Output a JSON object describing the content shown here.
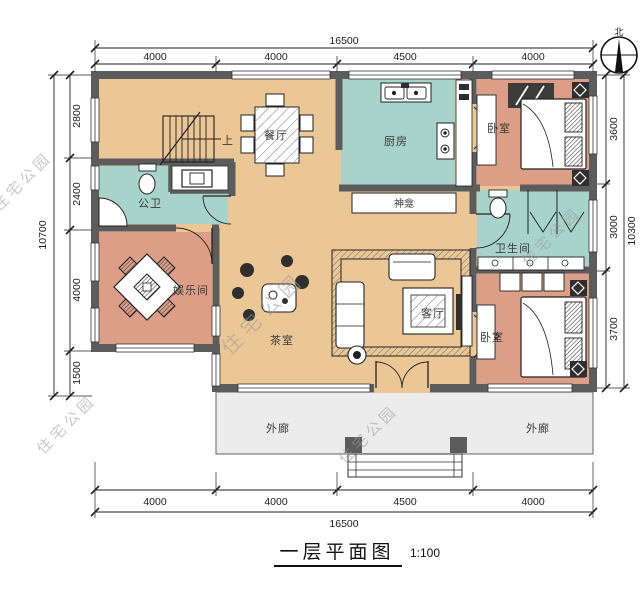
{
  "plan": {
    "title": "一层平面图",
    "scale": "1:100",
    "watermark": "住宅公园",
    "compass_label": "北"
  },
  "rooms": {
    "dining": "餐厅",
    "kitchen": "厨房",
    "bedroom": "卧室",
    "shrine": "神龛",
    "public_bath": "公卫",
    "entertainment": "娱乐间",
    "tea_room": "茶室",
    "living_room": "客厅",
    "bathroom": "卫生间",
    "porch": "外廊",
    "stairs_up": "上"
  },
  "dimensions": {
    "top": {
      "total": "16500",
      "segments": [
        "4000",
        "4000",
        "4500",
        "4000"
      ]
    },
    "bottom": {
      "total": "16500",
      "segments": [
        "4000",
        "4000",
        "4500",
        "4000"
      ]
    },
    "left": {
      "total": "10700",
      "segments": [
        "2800",
        "2400",
        "4000",
        "1500"
      ]
    },
    "right": {
      "total": "10300",
      "segments": [
        "3600",
        "3000",
        "3700"
      ]
    }
  },
  "colors": {
    "floor": "#eac795",
    "wet": "#a7d3cb",
    "bedroom": "#dd9e88",
    "wall": "#5c5c5c",
    "porch": "#ececec",
    "line": "#222222"
  }
}
